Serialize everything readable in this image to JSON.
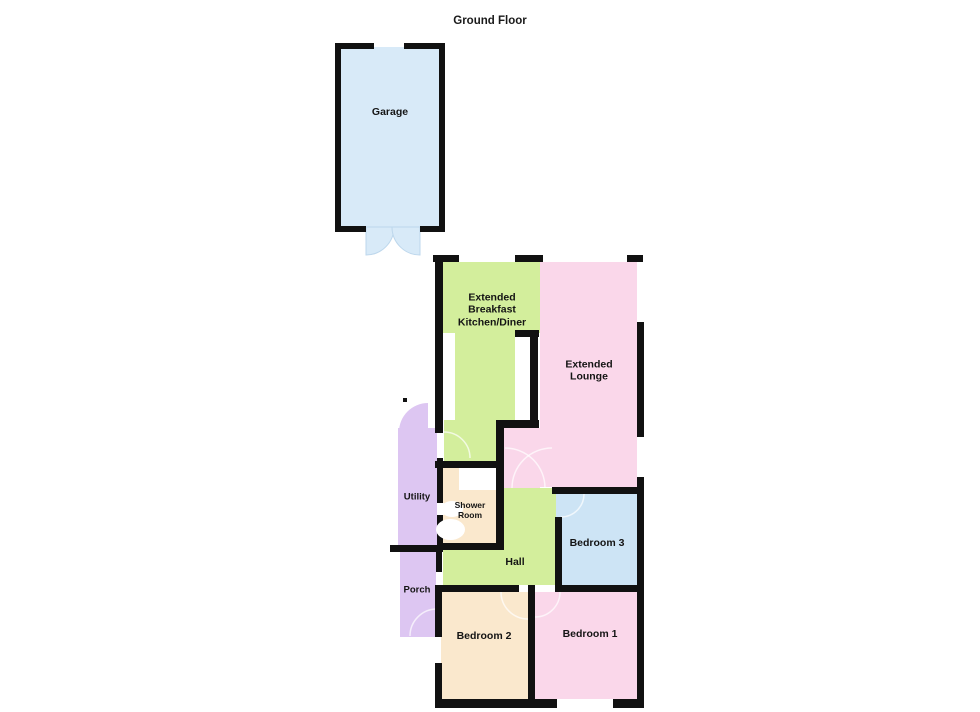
{
  "title": "Ground Floor",
  "rooms": {
    "garage": {
      "label": "Garage",
      "color": "#d8eaf8"
    },
    "kitchen": {
      "label": "Extended Breakfast Kitchen/Diner",
      "color": "#d3ee9c"
    },
    "lounge": {
      "label": "Extended Lounge",
      "color": "#fad7ea"
    },
    "utility": {
      "label": "Utility",
      "color": "#ddc6f2"
    },
    "shower": {
      "label": "Shower Room",
      "color": "#fae8cd"
    },
    "hall": {
      "label": "Hall",
      "color": "#d3ee9c"
    },
    "bedroom3": {
      "label": "Bedroom 3",
      "color": "#cde4f5"
    },
    "porch": {
      "label": "Porch",
      "color": "#ddc6f2"
    },
    "bedroom2": {
      "label": "Bedroom 2",
      "color": "#fae8cd"
    },
    "bedroom1": {
      "label": "Bedroom 1",
      "color": "#fad7ea"
    }
  },
  "colors": {
    "wall": "#111111",
    "background": "#ffffff",
    "door_swing_arc": "rgba(255,255,255,0.65)",
    "garage_door": "#d8eaf8",
    "garage_door_edge": "#bdd7ec",
    "utility_door": "#ddc6f2"
  }
}
